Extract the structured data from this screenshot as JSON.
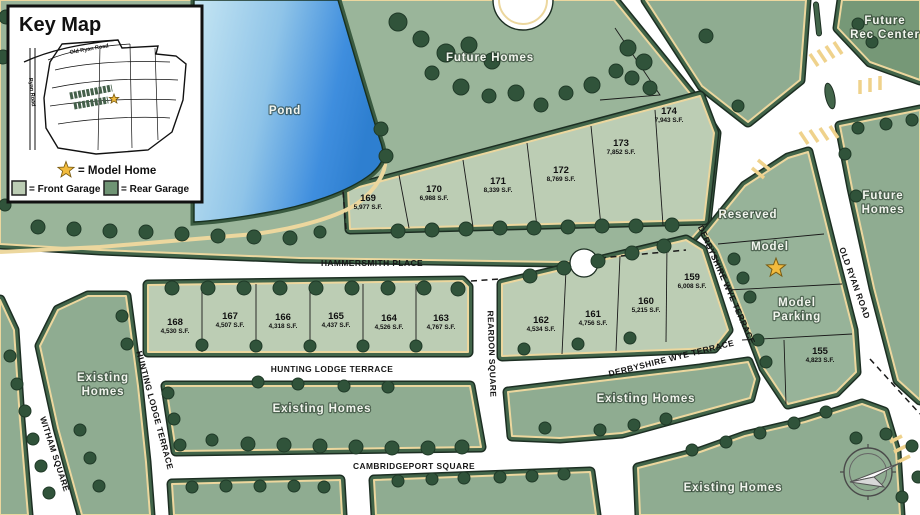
{
  "key_map": {
    "title": "Key Map",
    "inset": {
      "road_old_ryan": "Old Ryan Road",
      "road_ryan": "Ryan Road"
    },
    "legend": {
      "model_home": "= Model Home",
      "front_garage": "= Front Garage",
      "rear_garage": "= Rear Garage"
    },
    "colors": {
      "front_garage": "#bccdb4",
      "rear_garage": "#6f9474",
      "star": "#f2bb3d"
    }
  },
  "areas": {
    "pond": "Pond",
    "future_homes_top": "Future Homes",
    "future_rec_line1": "Future",
    "future_rec_line2": "Rec Center",
    "future_homes_right_line1": "Future",
    "future_homes_right_line2": "Homes",
    "reserved": "Reserved",
    "model": "Model",
    "model_parking_line1": "Model",
    "model_parking_line2": "Parking",
    "existing_left_line1": "Existing",
    "existing_left_line2": "Homes",
    "existing_center": "Existing Homes",
    "existing_mid_right": "Existing Homes",
    "existing_bottom_right": "Existing Homes"
  },
  "streets": {
    "hammersmith": "HAMMERSMITH PLACE",
    "hunting_lodge": "HUNTING LODGE TERRACE",
    "cambridgeport": "CAMBRIDGEPORT SQUARE",
    "witham": "WITHAM SQUARE",
    "reardon": "REARDON SQUARE",
    "derbyshire": "DERBYSHIRE WYE TERRACE",
    "old_ryan": "OLD RYAN ROAD"
  },
  "lots": [
    {
      "number": "155",
      "sqft": "4,823 S.F."
    },
    {
      "number": "159",
      "sqft": "6,008 S.F."
    },
    {
      "number": "160",
      "sqft": "5,215 S.F."
    },
    {
      "number": "161",
      "sqft": "4,756 S.F."
    },
    {
      "number": "162",
      "sqft": "4,534 S.F."
    },
    {
      "number": "163",
      "sqft": "4,767 S.F."
    },
    {
      "number": "164",
      "sqft": "4,526 S.F."
    },
    {
      "number": "165",
      "sqft": "4,437 S.F."
    },
    {
      "number": "166",
      "sqft": "4,318 S.F."
    },
    {
      "number": "167",
      "sqft": "4,507 S.F."
    },
    {
      "number": "168",
      "sqft": "4,530 S.F."
    },
    {
      "number": "169",
      "sqft": "5,977 S.F."
    },
    {
      "number": "170",
      "sqft": "6,988 S.F."
    },
    {
      "number": "171",
      "sqft": "8,339 S.F."
    },
    {
      "number": "172",
      "sqft": "8,769 S.F."
    },
    {
      "number": "173",
      "sqft": "7,852 S.F."
    },
    {
      "number": "174",
      "sqft": "7,943 S.F."
    }
  ]
}
